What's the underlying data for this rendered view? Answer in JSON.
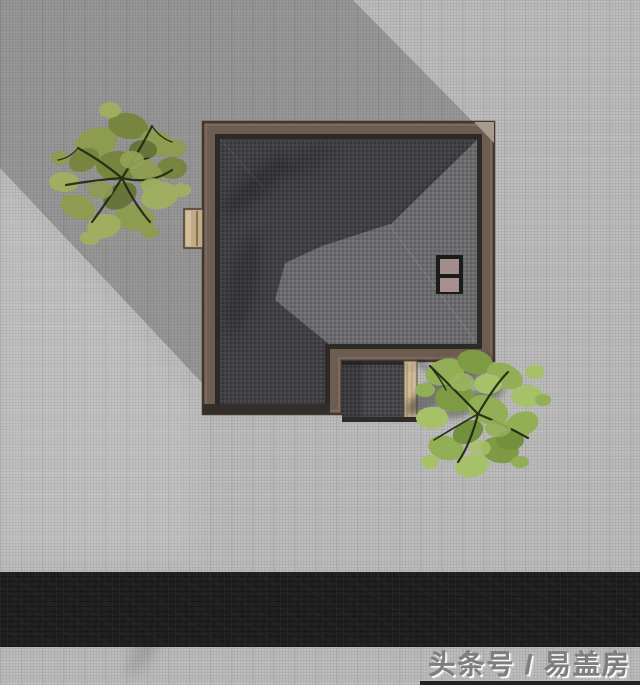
{
  "scene": {
    "description": "Top-down architectural rendering of a hip-roof house on paved ground with two trees, building shadow cast to upper-left, asphalt road along the bottom",
    "canvas": {
      "width": 640,
      "height": 685
    }
  },
  "watermark": {
    "text": "头条号 / 易盖房"
  },
  "palette": {
    "ground": "#bcbcbc",
    "building_shadow": "rgba(25,25,25,0.22)",
    "road_asphalt": "#201f1f",
    "roof_frame_brown": "#6d5c50",
    "roof_eave_dark": "#2c2926",
    "roof_plane_dark": "#404043",
    "roof_plane_mid": "#6c6c6f",
    "skylight_panel_mauve": "#a28f8d",
    "deck_tan": "#c7b18e",
    "tree1_foliage_olive": "#8e9c52",
    "tree2_foliage_green": "#93af55"
  },
  "elements": {
    "building": "L-shaped hip roof with brown fascia frame, twin-panel skylight, lower porch wing with wooden deck strip",
    "tree_count": 2,
    "road": "dark asphalt strip near bottom edge",
    "shadow_direction": "upper-left"
  }
}
